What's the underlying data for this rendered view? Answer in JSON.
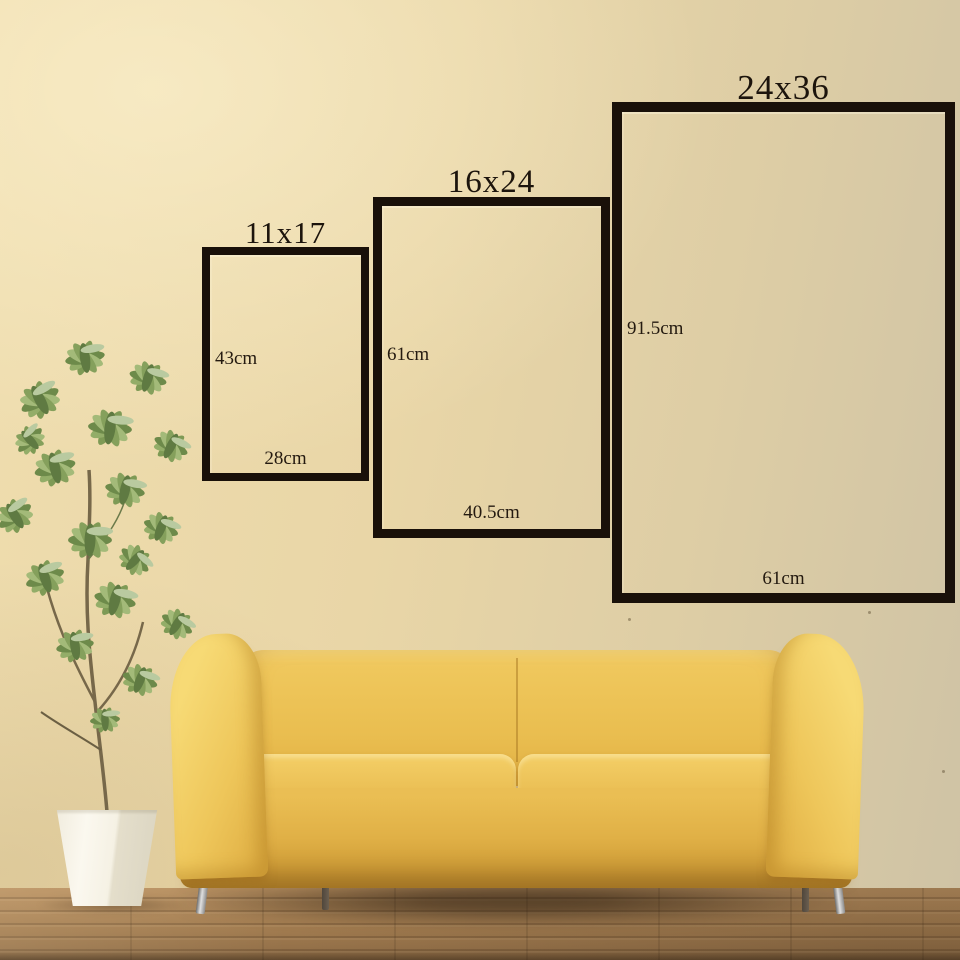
{
  "size_chart": {
    "frames": [
      {
        "size_name": "11x17",
        "height_label": "43cm",
        "width_label": "28cm"
      },
      {
        "size_name": "16x24",
        "height_label": "61cm",
        "width_label": "40.5cm"
      },
      {
        "size_name": "24x36",
        "height_label": "91.5cm",
        "width_label": "61cm"
      }
    ]
  },
  "scene": {
    "objects": [
      "wall",
      "wood-floor",
      "potted-plant",
      "white-planter",
      "yellow-sofa"
    ],
    "colors": {
      "wall": "#e8d5a6",
      "floor": "#a5805a",
      "sofa": "#edc356",
      "sofa_arm_highlight": "#f7da75",
      "pot": "#f5f1e6",
      "foliage": "#85a05c",
      "frame_border": "#191009",
      "label_text": "#241a10"
    }
  }
}
